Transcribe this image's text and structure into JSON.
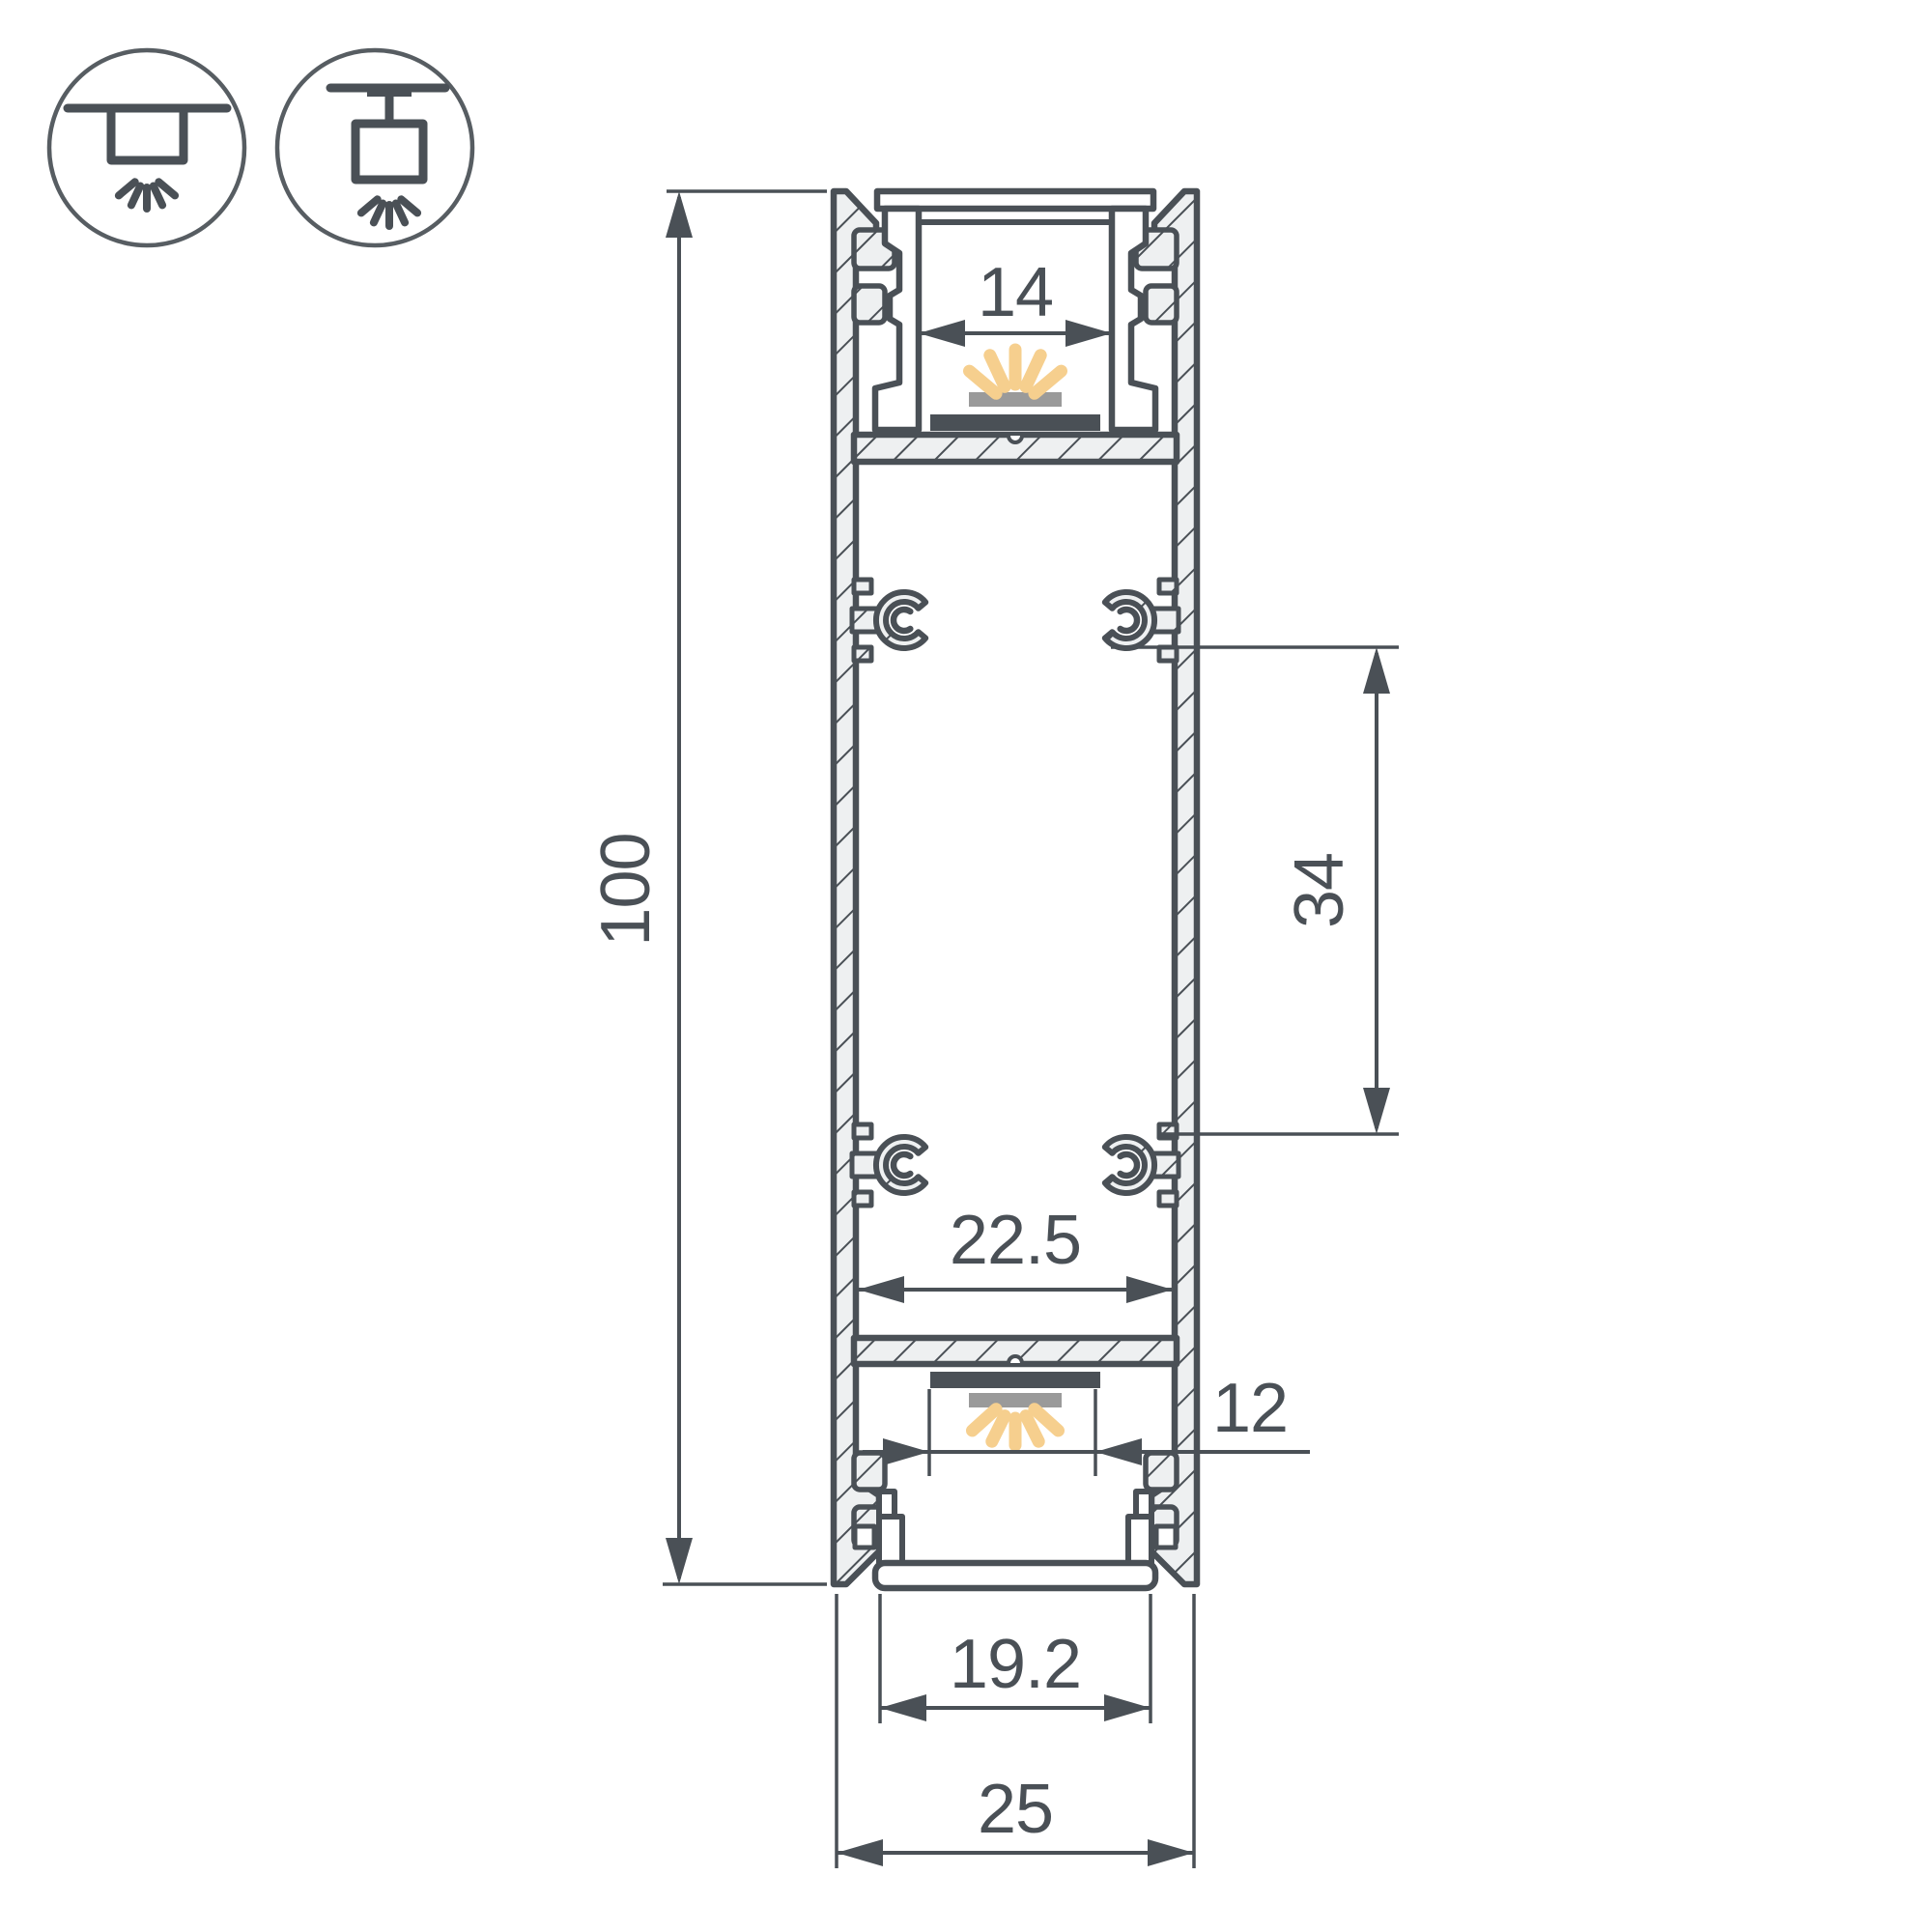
{
  "drawing": {
    "type": "technical-drawing",
    "subject": "double-sided LED aluminium profile cross-section",
    "units": "mm"
  },
  "colors": {
    "line": "#4a5056",
    "circle_stroke": "#575d62",
    "ray": "#f6cf8e",
    "diffuser": "#9a9a9a",
    "hatch_fill": "#eef0f1",
    "background": "#ffffff"
  },
  "icons": [
    {
      "name": "recessed-mount-icon",
      "meaning": "recessed ceiling mounting, light downward"
    },
    {
      "name": "surface-mount-icon",
      "meaning": "surface/suspended ceiling mounting, light downward"
    }
  ],
  "dimensions": {
    "height": "100",
    "top_opening": "14",
    "boss_spacing": "34",
    "inner_width": "22.5",
    "bottom_slot": "12",
    "bottom_opening": "19.2",
    "overall_width": "25"
  }
}
